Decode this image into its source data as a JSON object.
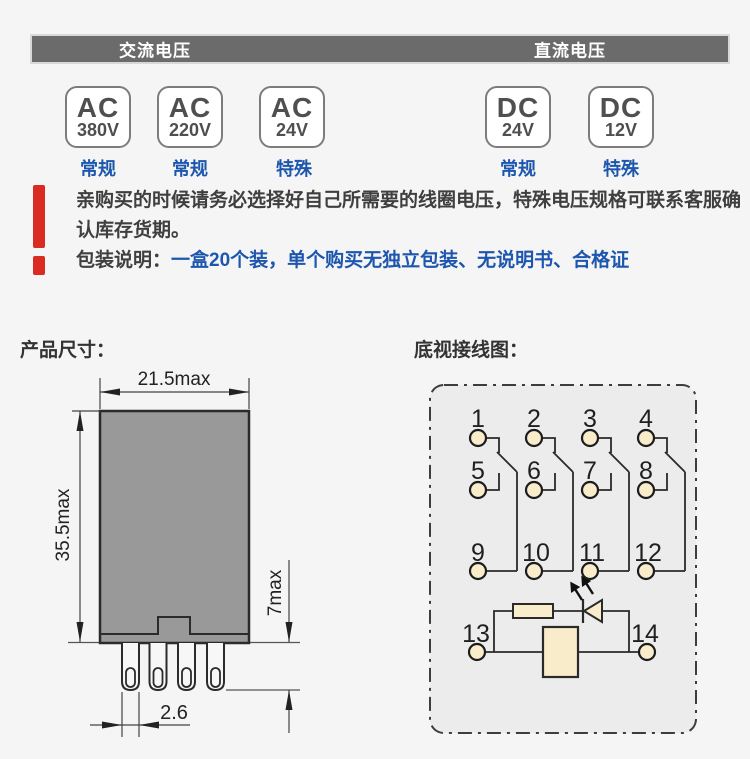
{
  "header": {
    "ac": "交流电压",
    "dc": "直流电压"
  },
  "voltages": [
    {
      "type": "AC",
      "value": "380V",
      "tag": "常规"
    },
    {
      "type": "AC",
      "value": "220V",
      "tag": "常规"
    },
    {
      "type": "AC",
      "value": "24V",
      "tag": "特殊"
    },
    {
      "type": "DC",
      "value": "24V",
      "tag": "常规"
    },
    {
      "type": "DC",
      "value": "12V",
      "tag": "特殊"
    }
  ],
  "notice": {
    "warning": "亲购买的时候请务必选择好自己所需要的线圈电压，特殊电压规格可联系客服确认库存货期。",
    "packaging_label": "包装说明：",
    "packaging_value": "一盒20个装，单个购买无独立包装、无说明书、合格证"
  },
  "sections": {
    "dimensions": "产品尺寸：",
    "wiring": "底视接线图："
  },
  "dimensions": {
    "width": "21.5max",
    "height": "35.5max",
    "pin_length": "7max",
    "pin_pitch": "2.6"
  },
  "wiring": {
    "pins": [
      "1",
      "2",
      "3",
      "4",
      "5",
      "6",
      "7",
      "8",
      "9",
      "10",
      "11",
      "12",
      "13",
      "14"
    ]
  },
  "colors": {
    "accent_blue": "#1d56ad",
    "warning_red": "#d92b21",
    "header_gray": "#6b6b6b",
    "relay_body_gray": "#999999",
    "terminal_cream": "#f8ecca"
  }
}
